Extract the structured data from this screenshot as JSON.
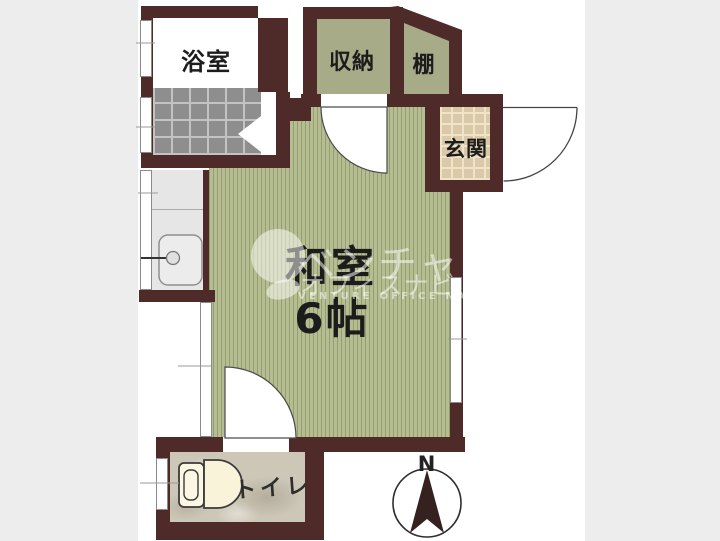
{
  "rooms": {
    "bath": "浴室",
    "closet": "収納",
    "shelf": "棚",
    "entrance": "玄関",
    "main_name": "和室",
    "main_size": "6帖",
    "toilet": "トイレ"
  },
  "compass": {
    "north": "N"
  },
  "watermark": {
    "line1": "ベンチャー",
    "line2": "オフィスナビ",
    "line3": "VENTURE OFFICE NAVI"
  },
  "colors": {
    "wall": "#4e2b28",
    "tatami": "#b6bd92",
    "closet": "#a8ab88",
    "bath_tile": "#8e8e8e",
    "bath_grout": "#c3c3c3",
    "genkan_tile": "#d9c9a8",
    "genkan_grout": "#efe4c8",
    "marble": "#cdc7b7",
    "counter": "#e6e6e6",
    "margin": "#ededed",
    "ink": "#1c1c1c"
  }
}
